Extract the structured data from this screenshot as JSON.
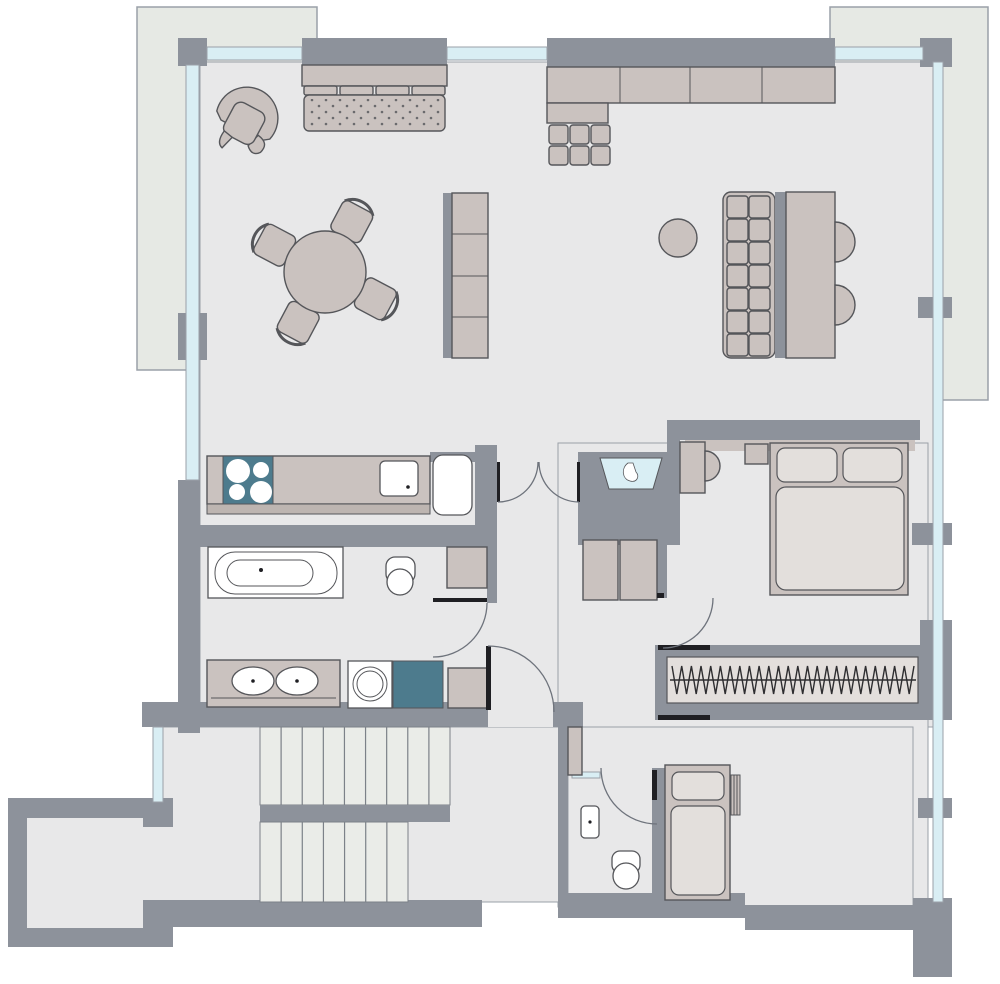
{
  "title": "apartment-floor-plan",
  "palette": {
    "bg": "#ffffff",
    "balcony": "#e6e9e4",
    "floor": "#e8e8e9",
    "wall": "#8d929b",
    "wallstroke": "#9aa0a8",
    "furn": "#cac2bf",
    "furnlight": "#e3dfdc",
    "white": "#ffffff",
    "teal": "#4d7b8d",
    "glass": "#d9eef4",
    "stroke": "#55565a",
    "stairfill": "#eaece8",
    "stairline": "#7c8188",
    "doorarc": "#6e737c",
    "dark": "#1f1f23",
    "rod": "#2e2e30"
  },
  "rooms": [
    {
      "name": "living-dining-room"
    },
    {
      "name": "kitchen"
    },
    {
      "name": "bathroom"
    },
    {
      "name": "washroom"
    },
    {
      "name": "hall"
    },
    {
      "name": "bedroom"
    },
    {
      "name": "closet"
    },
    {
      "name": "wc"
    },
    {
      "name": "child-room"
    },
    {
      "name": "stair-hall"
    },
    {
      "name": "terrace-top-left"
    },
    {
      "name": "terrace-top-right"
    }
  ],
  "furniture": [
    "sofa",
    "desk-chair",
    "sideboard",
    "round-dining-table",
    "dining-chairs",
    "shelf-unit",
    "bench-table-nook",
    "stool",
    "kitchen-counter",
    "cooktop",
    "kitchen-sink",
    "fridge",
    "bathtub",
    "toilet",
    "bath-cabinet",
    "double-vanity",
    "washing-machine",
    "laundry-appliance",
    "hall-cabinets",
    "foyer-basin",
    "dressing-table",
    "dressing-chair",
    "nightstand",
    "double-bed",
    "wardrobe-hangers",
    "single-bed",
    "radiator",
    "wc-sink",
    "wc-toilet",
    "stairs"
  ],
  "stairs": {
    "upper_lines": 9,
    "lower_lines": 7
  },
  "wardrobe": {
    "hanger_points": 50,
    "x1": 672,
    "x2": 914,
    "y_top": 666,
    "y_bot": 694,
    "rod_y": 680
  },
  "sofa": {
    "cushions": 4
  },
  "bench": {
    "tuft_cols": 2,
    "tuft_rows": 7
  },
  "sideboard": {
    "cols": 3,
    "rows": 2
  },
  "dining": {
    "chair_angles": [
      28,
      118,
      208,
      298
    ]
  }
}
